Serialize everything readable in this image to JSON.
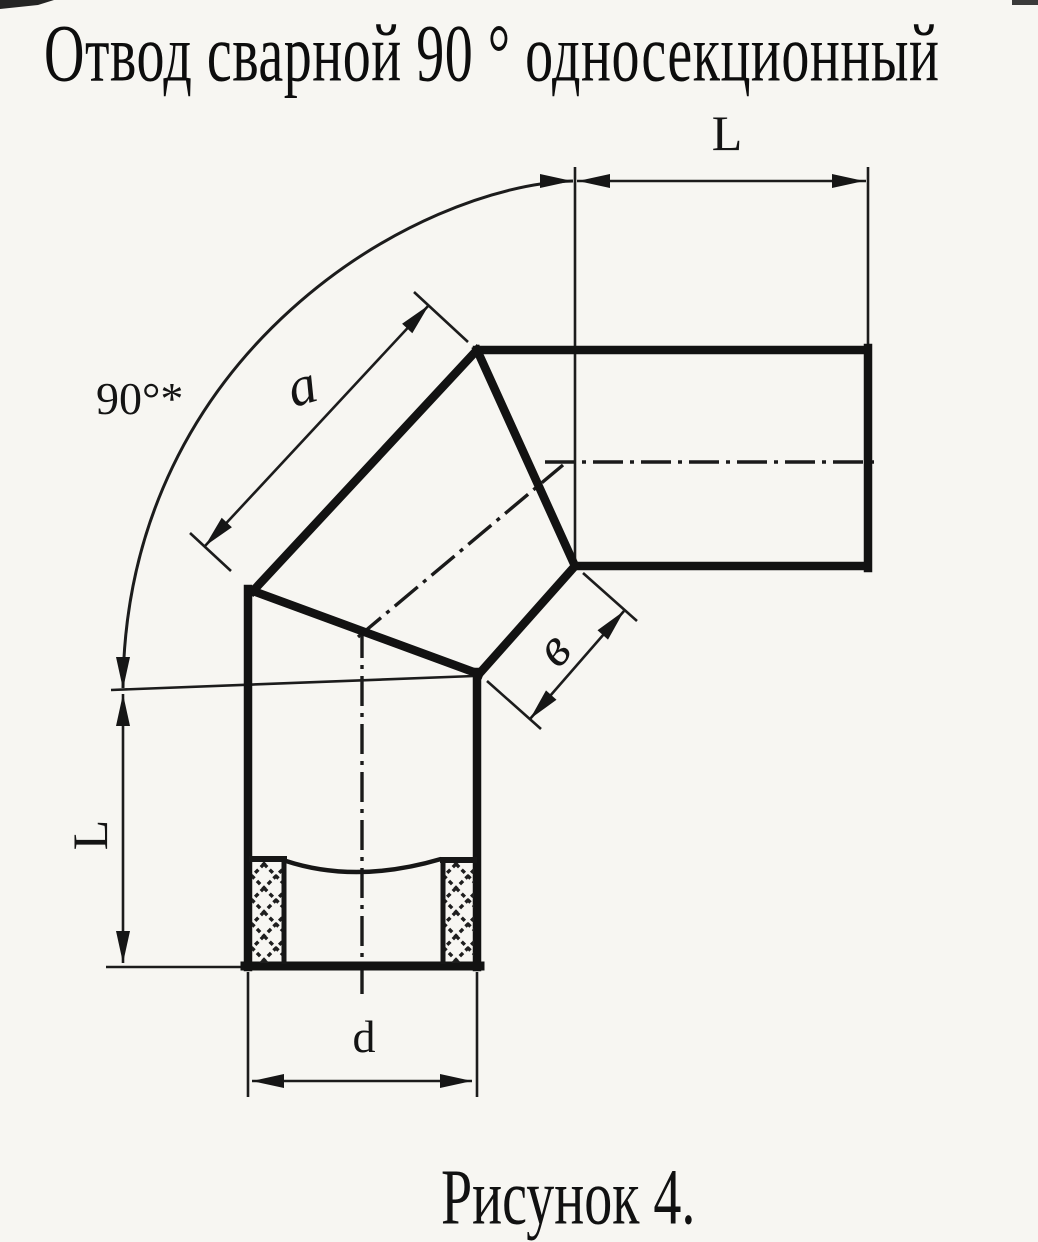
{
  "title": "Отвод сварной 90 ° односекционный",
  "caption": "Рисунок 4.",
  "dimensions": {
    "angle_label": "90°*",
    "top_length_label": "L",
    "left_length_label": "L",
    "outer_segment_label": "a",
    "inner_segment_label": "в",
    "diameter_label": "d"
  },
  "colors": {
    "paper": "#f7f6f2",
    "ink": "#1a1a1a"
  }
}
